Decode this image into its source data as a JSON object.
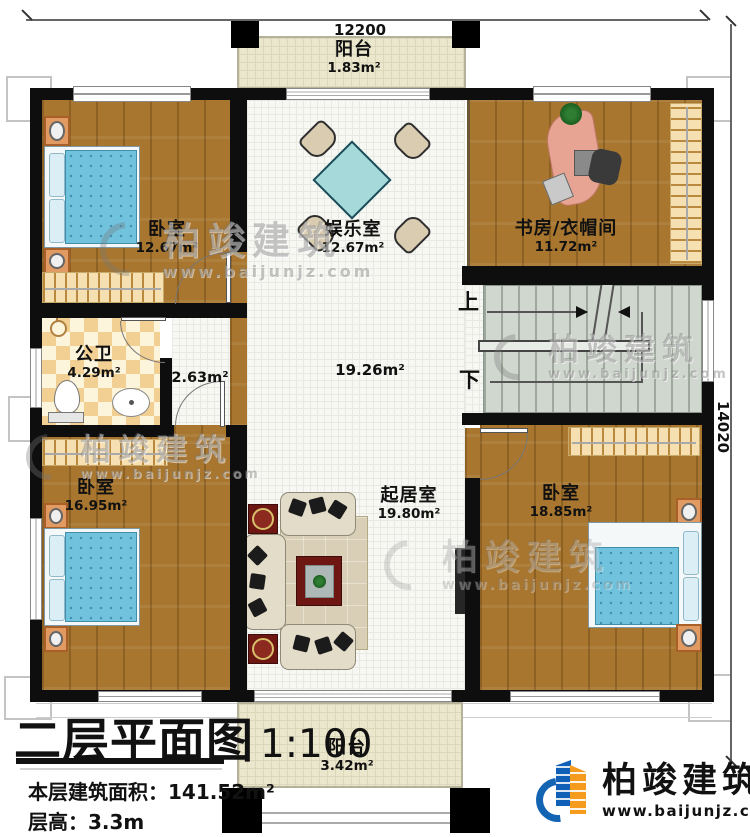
{
  "plan": {
    "dimensions": {
      "width": "12200",
      "height": "14020"
    },
    "stairs": {
      "up": "上",
      "down": "下"
    },
    "rooms": [
      {
        "name": "阳台",
        "area": "1.83m²"
      },
      {
        "name": "卧室",
        "area": "12.67m²"
      },
      {
        "name": "娱乐室",
        "area": "12.67m²"
      },
      {
        "name": "书房/衣帽间",
        "area": "11.72m²"
      },
      {
        "name": "公卫",
        "area": "4.29m²"
      },
      {
        "name": "",
        "area": "2.63m²"
      },
      {
        "name": "",
        "area": "19.26m²"
      },
      {
        "name": "卧室",
        "area": "16.95m²"
      },
      {
        "name": "起居室",
        "area": "19.80m²"
      },
      {
        "name": "卧室",
        "area": "18.85m²"
      },
      {
        "name": "阳台",
        "area": "3.42m²"
      }
    ]
  },
  "title_block": {
    "title": "二层平面图",
    "scale": "1:100",
    "area_label": "本层建筑面积：",
    "area_value": "141.52m²",
    "floor_height_label": "层高：",
    "floor_height_value": "3.3m"
  },
  "brand": {
    "name": "柏竣建筑",
    "website": "www.baijunjz.com"
  },
  "watermark": {
    "name": "柏竣建筑",
    "website": "www.baijunjz.com"
  },
  "colors": {
    "wall": "#0e0e0e",
    "wood": "#a8762f",
    "logo_blue": "#1464b4",
    "logo_orange": "#f59b1e"
  }
}
